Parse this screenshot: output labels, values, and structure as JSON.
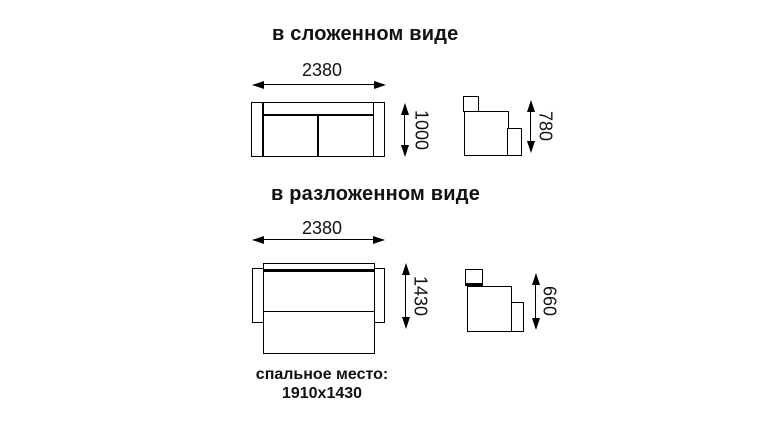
{
  "colors": {
    "background": "#ffffff",
    "line": "#000000",
    "text": "#111111"
  },
  "folded": {
    "title": "в сложенном виде",
    "width_label": "2380",
    "height_label": "1000",
    "side_height_label": "780"
  },
  "unfolded": {
    "title": "в разложенном виде",
    "width_label": "2380",
    "height_label": "1430",
    "side_height_label": "660"
  },
  "sleeping_area": {
    "label": "спальное место:",
    "dimensions": "1910x1430"
  }
}
